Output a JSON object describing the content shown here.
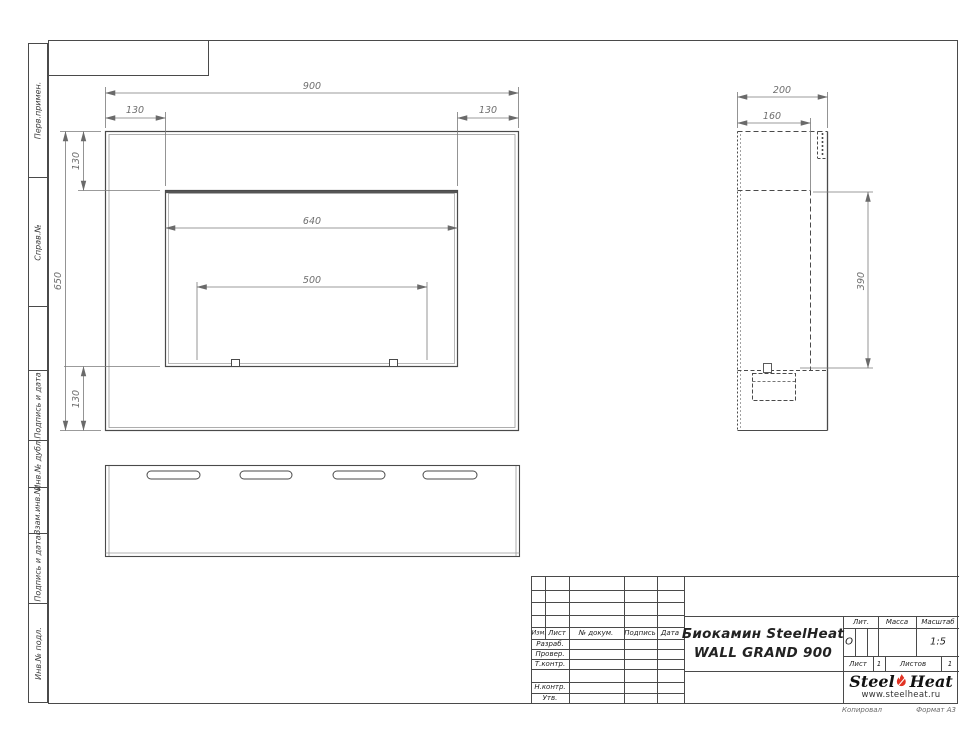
{
  "sheet": {
    "copied_label": "Копировал",
    "format_label": "Формат А3"
  },
  "margin": {
    "cells": [
      {
        "label": "Перв.примен."
      },
      {
        "label": "Справ.№"
      },
      {
        "label": ""
      },
      {
        "label": "Подпись и дата"
      },
      {
        "label": "Инв.№ дубл."
      },
      {
        "label": "Взам.инв.№"
      },
      {
        "label": "Подпись и дата"
      },
      {
        "label": "Инв.№ подл."
      }
    ]
  },
  "dims": {
    "front_width": "900",
    "front_height": "650",
    "inset": "130",
    "window_width": "640",
    "burner_spacing": "500",
    "depth": "200",
    "inner_depth": "160",
    "lower_height": "390"
  },
  "title_block": {
    "cols": {
      "izm": "Изм.",
      "list": "Лист",
      "doc": "№ докум.",
      "sign": "Подпись",
      "date": "Дата"
    },
    "rows": {
      "razrab": "Разраб.",
      "prover": "Провер.",
      "tkontr": "Т.контр.",
      "nkontr": "Н.контр.",
      "utv": "Утв."
    },
    "title_line1": "Биокамин SteelHeat",
    "title_line2": "WALL GRAND 900",
    "lit": {
      "label": "Лит.",
      "value": "О"
    },
    "massa": {
      "label": "Масса"
    },
    "scale": {
      "label": "Масштаб",
      "value": "1:5"
    },
    "sheet_no": {
      "label": "Лист",
      "value": "1"
    },
    "sheets_total": {
      "label": "Листов",
      "value": "1"
    },
    "logo": {
      "steel": "Steel",
      "heat": "Heat",
      "site": "www.steelheat.ru"
    }
  }
}
